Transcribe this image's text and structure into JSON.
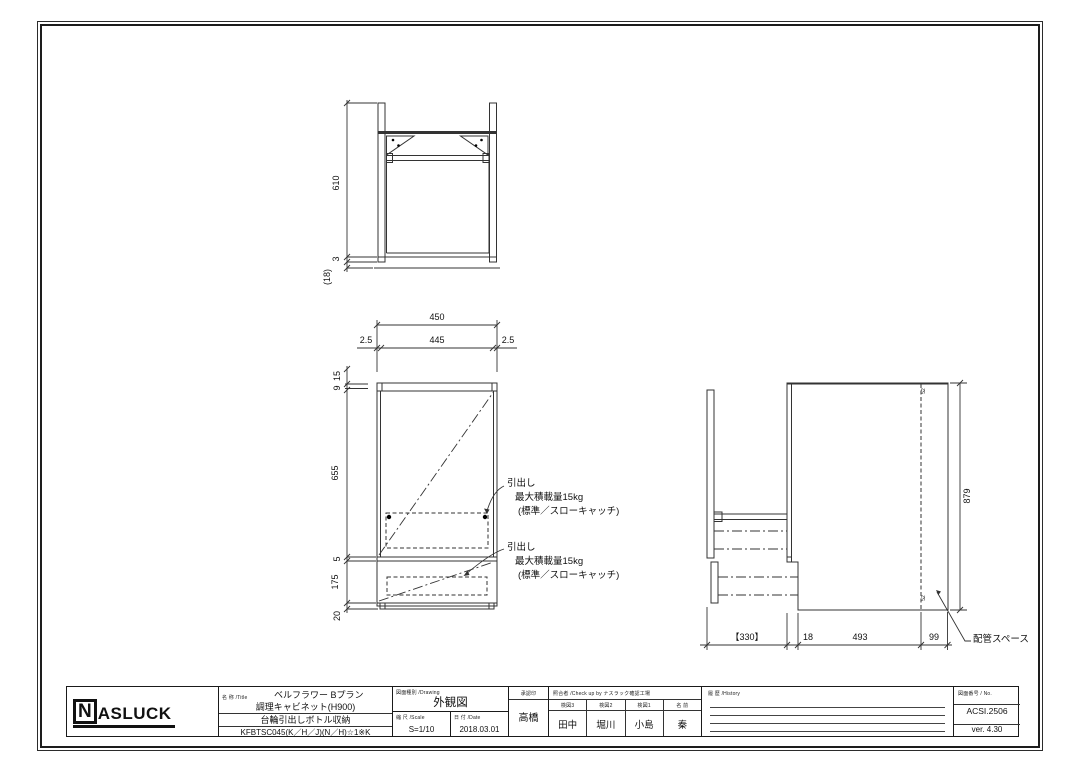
{
  "top_view": {
    "dim_height": "610",
    "dim_bottom_gap": "3",
    "dim_base": "(18)"
  },
  "front_view": {
    "dim_width_overall": "450",
    "dim_width_left": "2.5",
    "dim_width_center": "445",
    "dim_width_right": "2.5",
    "dim_h_15": "15",
    "dim_h_9": "9",
    "dim_h_door": "655",
    "dim_h_gap": "5",
    "dim_h_drawer": "175",
    "dim_h_base": "20",
    "annotation_upper": {
      "title": "引出し",
      "capacity": "最大積載量15kg",
      "note": "(標準／スローキャッチ)"
    },
    "annotation_lower": {
      "title": "引出し",
      "capacity": "最大積載量15kg",
      "note": "(標準／スローキャッチ)"
    }
  },
  "side_view": {
    "dim_height": "879",
    "dim_drawer_pullout": "【330】",
    "dim_front_gap": "18",
    "dim_depth": "493",
    "dim_pipe_space": "99",
    "pipe_space_label": "配管スペース",
    "tiny_note_top": "52",
    "tiny_note_bottom": "52"
  },
  "title_block": {
    "logo_n": "N",
    "logo_rest": "ASLUCK",
    "name_label": "名 称 /Title",
    "name_line1": "ベルフラワー Bプラン",
    "name_line2": "調理キャビネット(H900)",
    "name_line3": "台輪引出しボトル収納",
    "name_line4": "KFBTSC045(K／H／J)(N／H)☆1※K",
    "drawing_label": "図面種別 /Drawing",
    "drawing_value": "外観図",
    "scale_label": "縮 尺 /Scale",
    "scale_value": "S=1/10",
    "date_label": "日 付 /Date",
    "date_value": "2018.03.01",
    "approval_label": "承認印",
    "approval_value": "高橋",
    "check_label": "照合者 /Check up by ナスラック確認工場",
    "check_cols": [
      {
        "label": "検図3",
        "value": "田中"
      },
      {
        "label": "検図2",
        "value": "堀川"
      },
      {
        "label": "検図1",
        "value": "小島"
      },
      {
        "label": "名 前",
        "value": "秦"
      }
    ],
    "history_label": "履 歴 /History",
    "no_label": "図面番号 / No.",
    "no_value": "ACSI.2506",
    "version": "ver. 4.30"
  }
}
